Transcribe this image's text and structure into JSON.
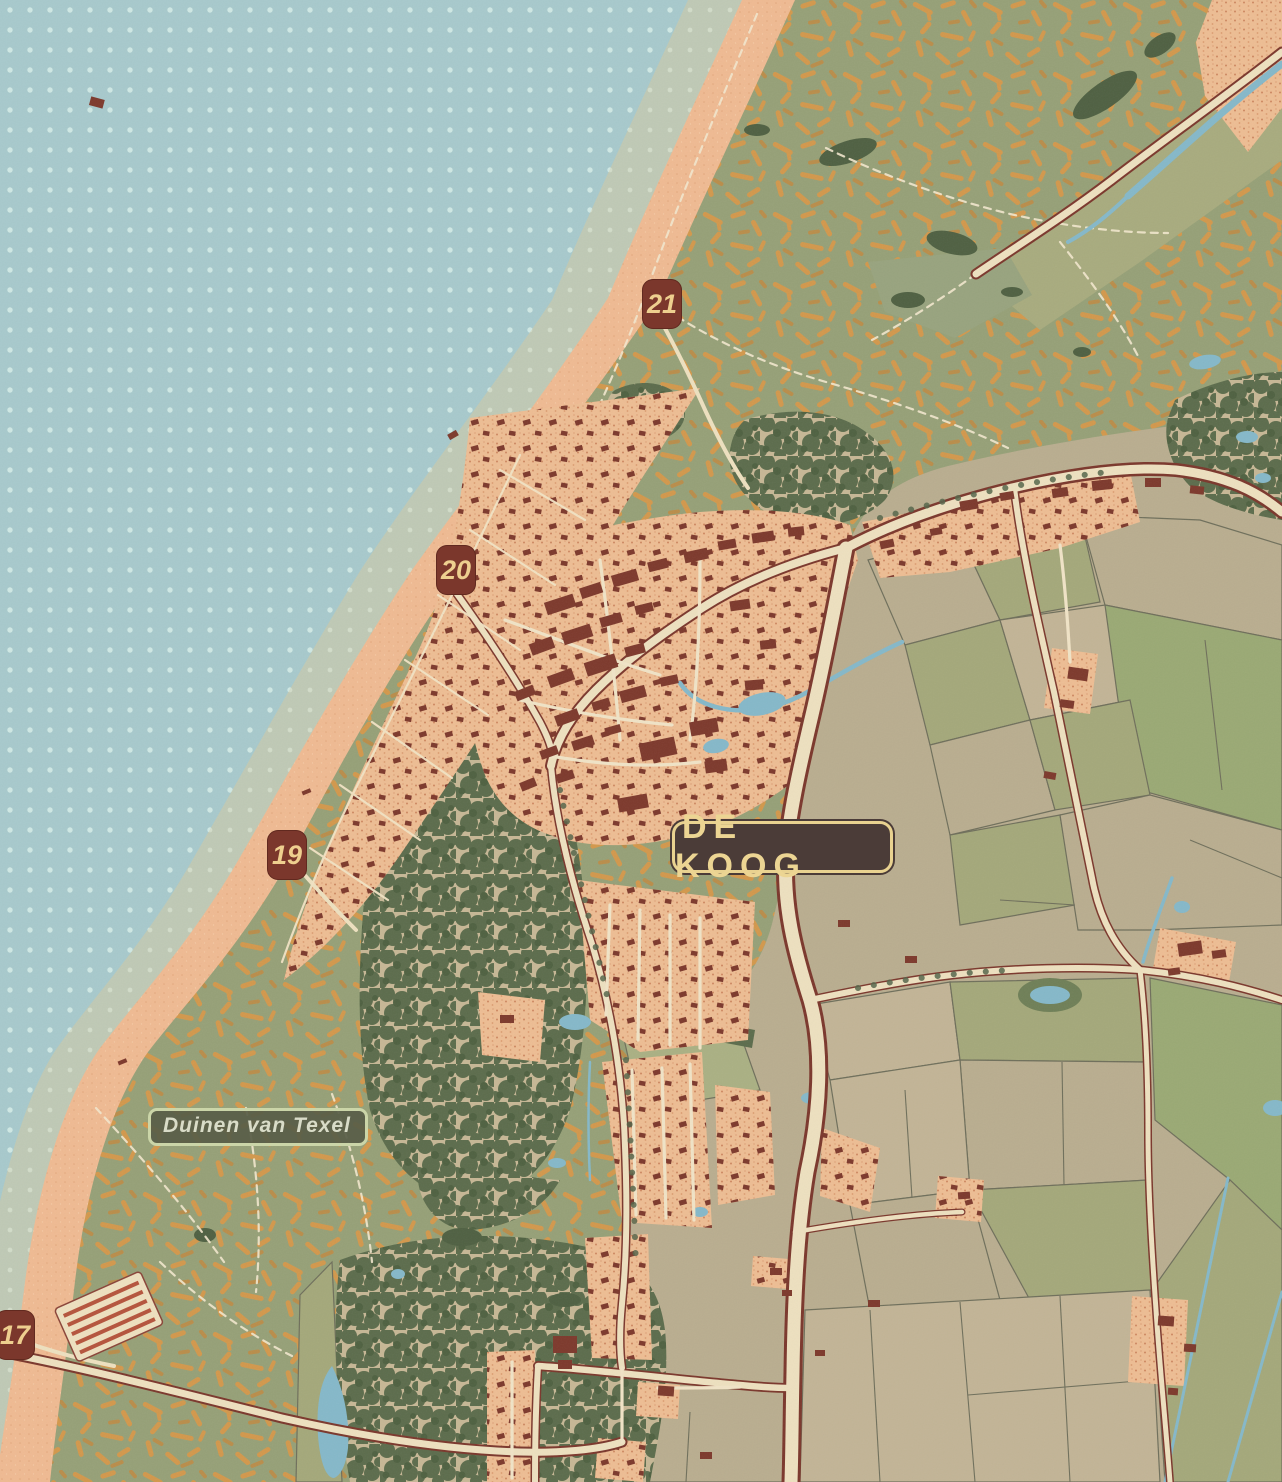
{
  "map_title": "De Koog, Texel",
  "labels": {
    "village": "DE KOOG",
    "nature_area": "Duinen van Texel"
  },
  "beach_posts": [
    {
      "label": "21"
    },
    {
      "label": "20"
    },
    {
      "label": "19"
    },
    {
      "label": "17"
    }
  ],
  "colors": {
    "sea": "#a7c9cc",
    "sea_dot": "#cfe8e4",
    "wet_sand": "#bfc9b5",
    "beach": "#efba92",
    "dune_base": "#96a077",
    "dune_stroke": "#d2984c",
    "forest": "#5c6c4c",
    "field_beige": "#b9ad8f",
    "field_olive": "#a4a87a",
    "settlement_fill": "#edbd93",
    "building": "#7d392c",
    "road_fill": "#ede0bf",
    "road_casing": "#7b372c",
    "water": "#85b8c9",
    "village_label_bg": "#4b3c38",
    "village_label_text": "#ecd593",
    "village_label_border": "#e9d290",
    "nature_label_bg": "#585e48",
    "nature_label_text": "#d9dcc8",
    "marker_bg": "#7b372c",
    "marker_text": "#eecf8f"
  }
}
